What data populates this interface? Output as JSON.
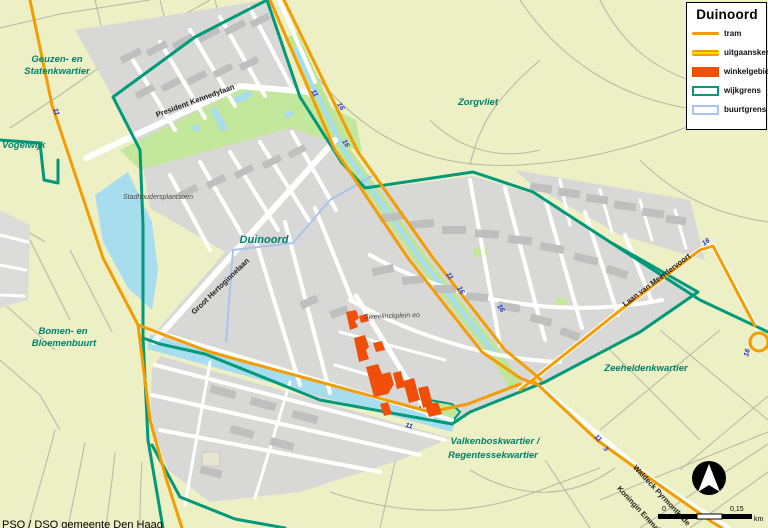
{
  "legend": {
    "title": "Duinoord",
    "items": [
      {
        "id": "tram",
        "label": "tram"
      },
      {
        "id": "uitgaanskern",
        "label": "uitgaanskern"
      },
      {
        "id": "winkelgebied",
        "label": "winkelgebied"
      },
      {
        "id": "wijkgrens",
        "label": "wijkgrens"
      },
      {
        "id": "buurtgrens",
        "label": "buurtgrens"
      }
    ]
  },
  "districts": {
    "geuzen_line1": "Geuzen- en",
    "geuzen_line2": "Statenkwartier",
    "vogelwijk": "Vogelwijk",
    "zorgvliet": "Zorgvliet",
    "duinoord": "Duinoord",
    "bomen_line1": "Bomen- en",
    "bomen_line2": "Bloemenbuurt",
    "zeehelden": "Zeeheldenkwartier",
    "valkenbos_line1": "Valkenboskwartier /",
    "valkenbos_line2": "Regentessekwartier"
  },
  "streets": {
    "kennedylaan": "President Kennedylaan",
    "hertoginnelaan": "Groot Hertoginnelaan",
    "meerdervoort": "Laan van Meerdervoort",
    "waldeck": "Waldeck Pyrmontkade",
    "koningin": "Koningin Emmakade",
    "sweelinck": "Sweelinckplein eo",
    "stadhouders": "Stadhoudersplantsoen"
  },
  "tram_badges": [
    "11",
    "11",
    "16",
    "16",
    "11",
    "16",
    "16",
    "16",
    "16",
    "11",
    "11",
    "3"
  ],
  "scale_bar": {
    "start": "0",
    "end": "0,15",
    "unit": "km"
  },
  "credit": "PSO / DSO gemeente Den Haag",
  "colors": {
    "background": "#edf0c5",
    "urban": "#d8d8d6",
    "park": "#c3e79b",
    "water": "#a8ddf0",
    "tram": "#f49c00",
    "uitgaanskern_core": "#ffd900",
    "winkelgebied": "#f04f0a",
    "wijkgrens": "#00997a",
    "buurtgrens": "#a9c3ee",
    "district_label": "#00816b",
    "tram_number": "#2336cf"
  }
}
